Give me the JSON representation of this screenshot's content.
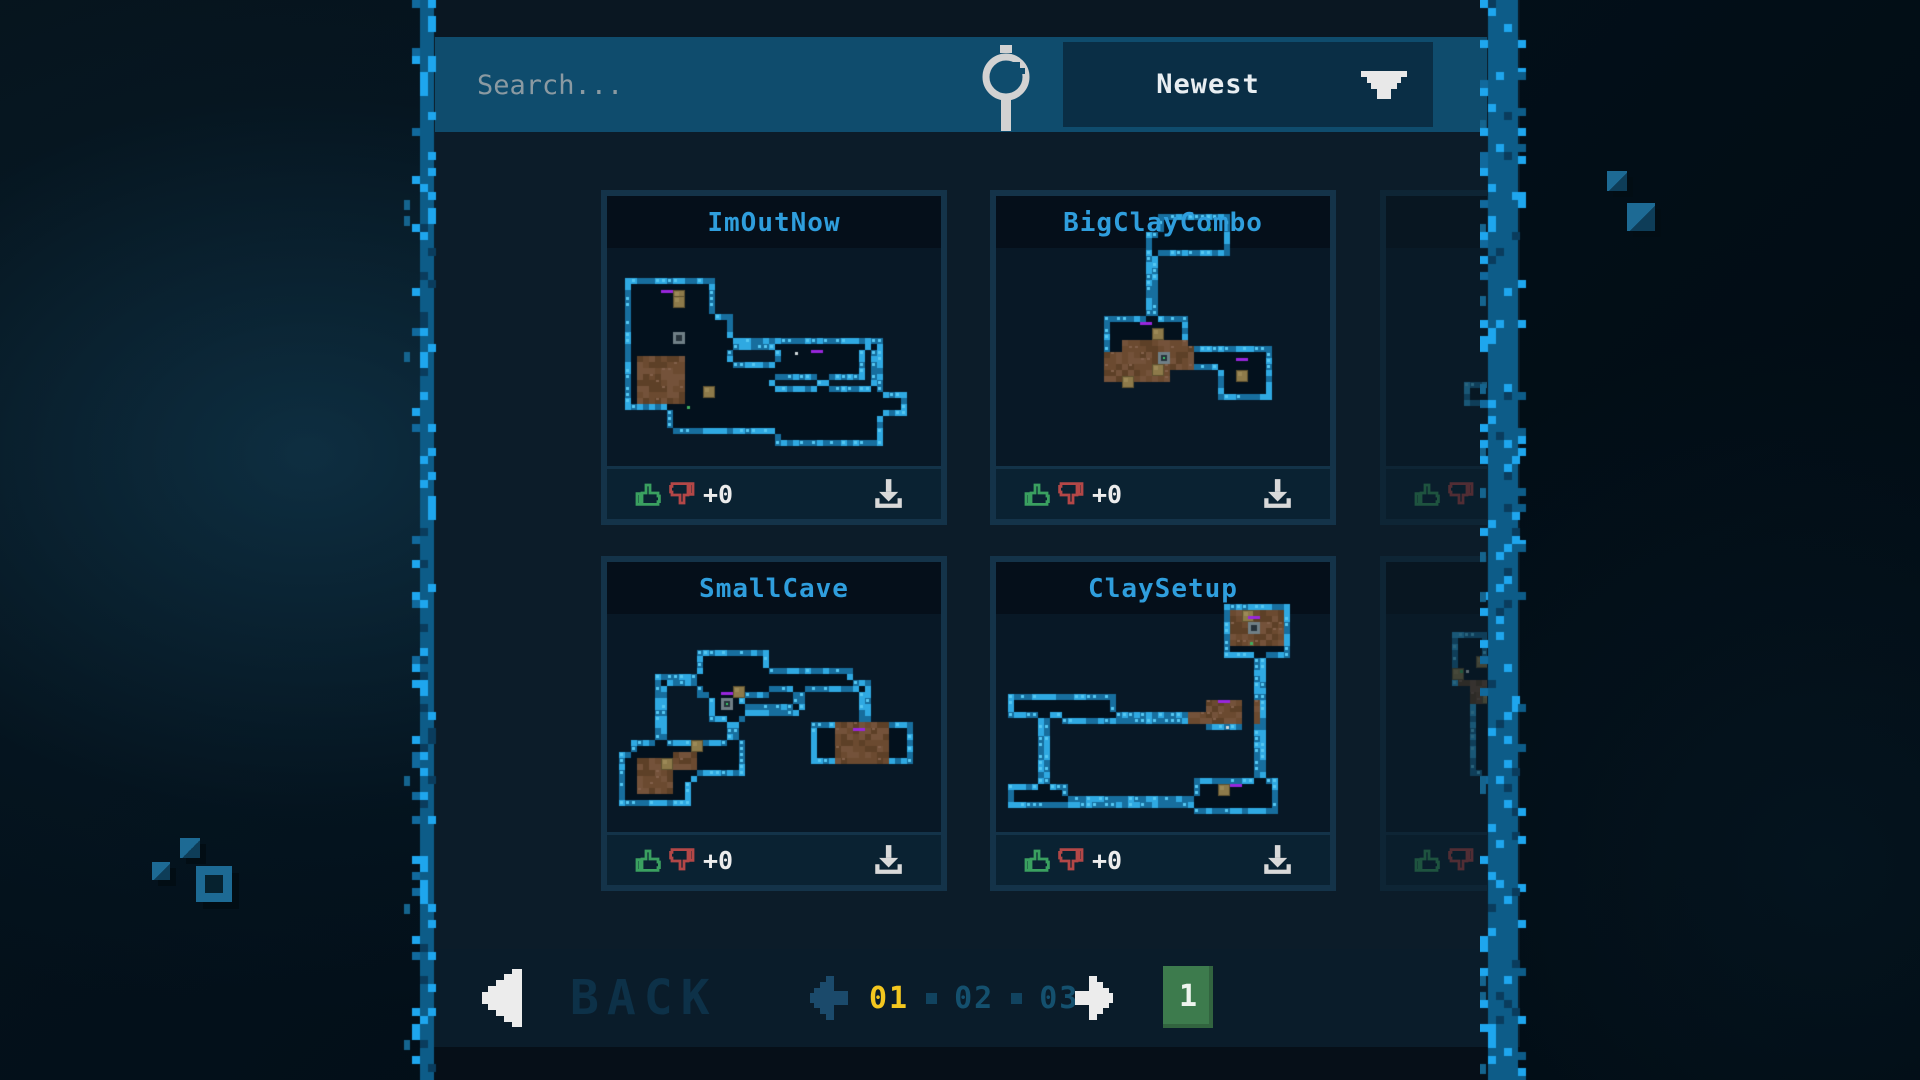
{
  "topbar": {
    "search_placeholder": "Search...",
    "sort_value": "Newest"
  },
  "cards": [
    {
      "title": "ImOutNow",
      "votes": "+0",
      "dimmed": false,
      "overlap": false,
      "map_seed": 31
    },
    {
      "title": "BigClayCombo",
      "votes": "+0",
      "dimmed": false,
      "overlap": true,
      "map_seed": 87
    },
    {
      "title": "",
      "votes": "",
      "dimmed": true,
      "overlap": true,
      "map_seed": 52
    },
    {
      "title": "SmallCave",
      "votes": "+0",
      "dimmed": false,
      "overlap": false,
      "map_seed": 14
    },
    {
      "title": "ClaySetup",
      "votes": "+0",
      "dimmed": false,
      "overlap": true,
      "map_seed": 66
    },
    {
      "title": "Flat",
      "votes": "",
      "dimmed": true,
      "overlap": false,
      "map_seed": 23
    }
  ],
  "bottombar": {
    "back_label": "BACK",
    "pages": [
      "01",
      "02",
      "03"
    ],
    "current_page": "01",
    "badge": "1"
  },
  "colors": {
    "title_blue": "#2f9edd",
    "like_green": "#3aa060",
    "dislike_red": "#b34747",
    "page_current_yellow": "#f4c71f",
    "badge_green": "#3d7b4d",
    "border_bright_blue": "#1ea6ee",
    "search_bar_blue": "#0f4c6d"
  }
}
